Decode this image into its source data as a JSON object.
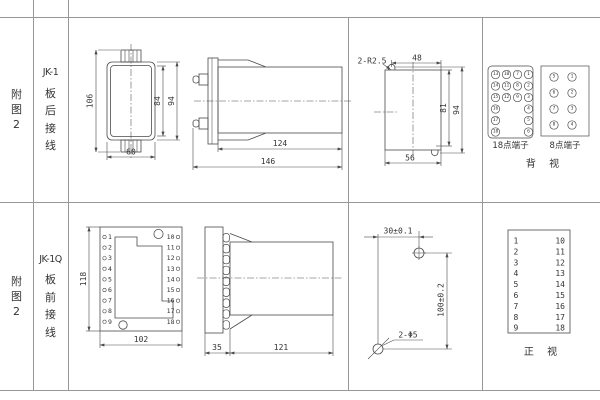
{
  "colors": {
    "drawing_line": "#4a4a4a",
    "grid_line": "#979797",
    "text": "#333333"
  },
  "left_panel": {
    "top": {
      "fig": [
        "附",
        "图",
        "2"
      ],
      "model": "JK-1",
      "wiring": [
        "板",
        "后",
        "接",
        "线"
      ]
    },
    "bottom": {
      "fig": [
        "附",
        "图",
        "2"
      ],
      "model": "JK-1Q",
      "wiring": [
        "板",
        "前",
        "接",
        "线"
      ]
    }
  },
  "top_row": {
    "front_view": {
      "dims": {
        "overall_height": "106",
        "inner_height": "84",
        "case_height": "94",
        "width": "60"
      }
    },
    "side_view": {
      "dims": {
        "case_length": "124",
        "total_length": "146"
      }
    },
    "cutout": {
      "slot_label": "2-R2.5",
      "dims": {
        "top_width": "48",
        "inner_height": "81",
        "overall_height": "94",
        "bottom_width": "56"
      }
    },
    "terminals_18": {
      "label": "18点端子",
      "grid": [
        [
          "13",
          "10",
          "7",
          "1"
        ],
        [
          "14",
          "11",
          "8",
          "2"
        ],
        [
          "15",
          "12",
          "9",
          "3"
        ],
        [
          "16",
          "4"
        ],
        [
          "17",
          "5"
        ],
        [
          "18",
          "6"
        ]
      ]
    },
    "terminals_8": {
      "label": "8点端子",
      "grid": [
        [
          "5",
          "1"
        ],
        [
          "6",
          "2"
        ],
        [
          "7",
          "3"
        ],
        [
          "8",
          "4"
        ]
      ]
    },
    "view_label": "背 视"
  },
  "bottom_row": {
    "front_view": {
      "dims": {
        "height": "118",
        "width": "102"
      },
      "left_terminals": [
        "1",
        "2",
        "3",
        "4",
        "5",
        "6",
        "7",
        "8",
        "9"
      ],
      "right_terminals": [
        "10",
        "11",
        "12",
        "13",
        "14",
        "15",
        "16",
        "17",
        "18"
      ]
    },
    "side_view": {
      "dims": {
        "flange_depth": "35",
        "case_length": "121"
      }
    },
    "drill_plan": {
      "dims": {
        "h_spacing": "30±0.1",
        "v_spacing": "100±0.2"
      },
      "hole_label": "2-Φ5"
    },
    "terminal_table": {
      "left": [
        "1",
        "2",
        "3",
        "4",
        "5",
        "6",
        "7",
        "8",
        "9"
      ],
      "right": [
        "10",
        "11",
        "12",
        "13",
        "14",
        "15",
        "16",
        "17",
        "18"
      ]
    },
    "view_label": "正 视"
  }
}
